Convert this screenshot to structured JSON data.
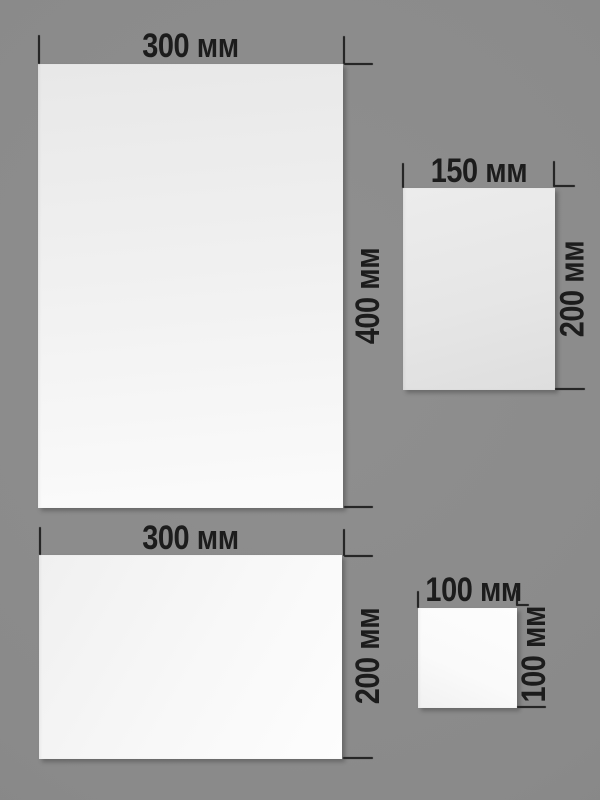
{
  "unit": "мм",
  "colors": {
    "background": "#8a8a8a",
    "sheet": "#f2f2f2",
    "label": "#1c1c1c",
    "tick": "#262626"
  },
  "sheets": [
    {
      "name": "sheet-300x400",
      "width_mm": 300,
      "height_mm": 400,
      "width_label": "300 мм",
      "height_label": "400 мм"
    },
    {
      "name": "sheet-150x200",
      "width_mm": 150,
      "height_mm": 200,
      "width_label": "150 мм",
      "height_label": "200 мм"
    },
    {
      "name": "sheet-300x200",
      "width_mm": 300,
      "height_mm": 200,
      "width_label": "300 мм",
      "height_label": "200 мм"
    },
    {
      "name": "sheet-100x100",
      "width_mm": 100,
      "height_mm": 100,
      "width_label": "100 мм",
      "height_label": "100 мм"
    }
  ]
}
